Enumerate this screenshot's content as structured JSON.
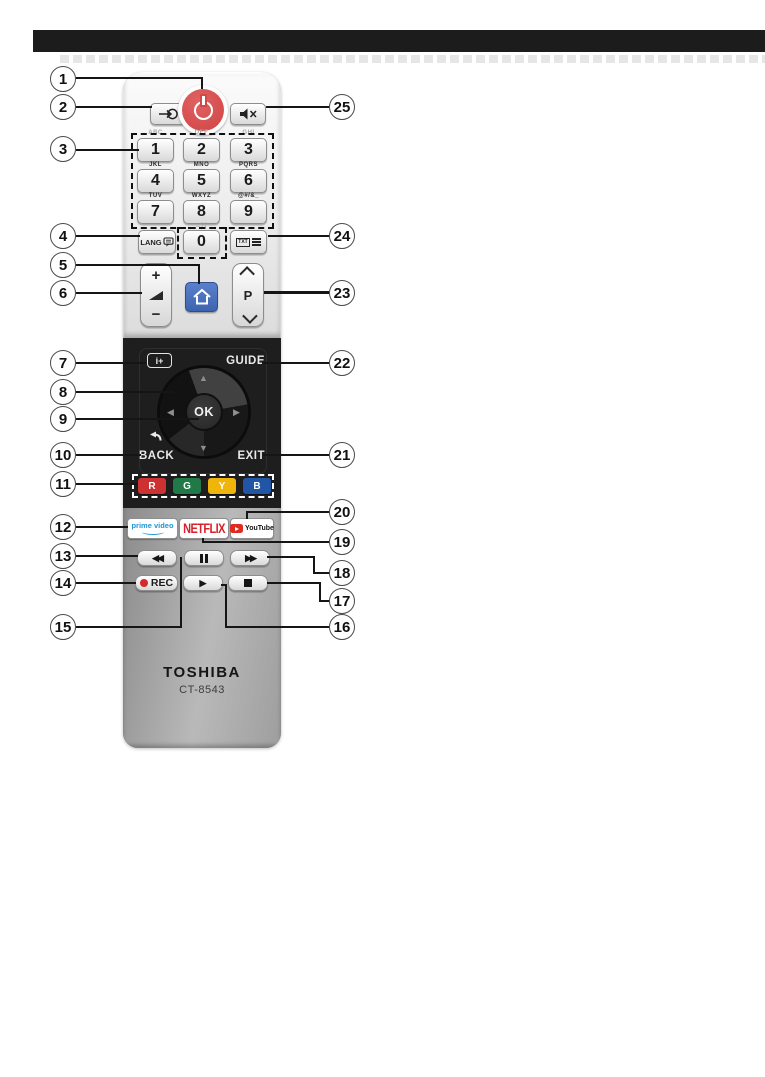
{
  "remote": {
    "brand": "TOSHIBA",
    "model": "CT-8543",
    "keypad": {
      "keys": [
        {
          "digit": "1",
          "letters": "ABC"
        },
        {
          "digit": "2",
          "letters": "DEF"
        },
        {
          "digit": "3",
          "letters": "GHI"
        },
        {
          "digit": "4",
          "letters": "JKL"
        },
        {
          "digit": "5",
          "letters": "MNO"
        },
        {
          "digit": "6",
          "letters": "PQRS"
        },
        {
          "digit": "7",
          "letters": "TUV"
        },
        {
          "digit": "8",
          "letters": "WXYZ"
        },
        {
          "digit": "9",
          "letters": "@#/&_"
        },
        {
          "digit": "0",
          "letters": "..?!"
        }
      ],
      "lang": "LANG",
      "txt": "TXT"
    },
    "nav": {
      "info": "i+",
      "guide": "GUIDE",
      "ok": "OK",
      "back": "BACK",
      "exit": "EXIT"
    },
    "rockers": {
      "volume_plus": "+",
      "volume_minus": "−",
      "program": "P"
    },
    "color_keys": [
      {
        "label": "R",
        "color": "#ce3131"
      },
      {
        "label": "G",
        "color": "#1f7a47"
      },
      {
        "label": "Y",
        "color": "#efb50a"
      },
      {
        "label": "B",
        "color": "#2156a6"
      }
    ],
    "apps": {
      "prime": "prime video",
      "netflix": "NETFLIX",
      "youtube": "YouTube"
    },
    "transport": {
      "rec": "REC"
    },
    "icons": {
      "up": "▲",
      "down": "▼",
      "left": "◀",
      "right": "▶",
      "rewind": "◀◀",
      "fast_forward": "▶▶",
      "play": "▶"
    },
    "colors": {
      "power_red": "#d04444",
      "home_blue": "#4a70bd",
      "netflix_red": "#d6202a",
      "prime_blue": "#1e95d4",
      "youtube_red": "#e02b20"
    }
  },
  "callouts": {
    "left": [
      "1",
      "2",
      "3",
      "4",
      "5",
      "6",
      "7",
      "8",
      "9",
      "10",
      "11",
      "12",
      "13",
      "14",
      "15"
    ],
    "right": [
      "25",
      "24",
      "23",
      "22",
      "21",
      "20",
      "19",
      "18",
      "17",
      "16"
    ]
  }
}
